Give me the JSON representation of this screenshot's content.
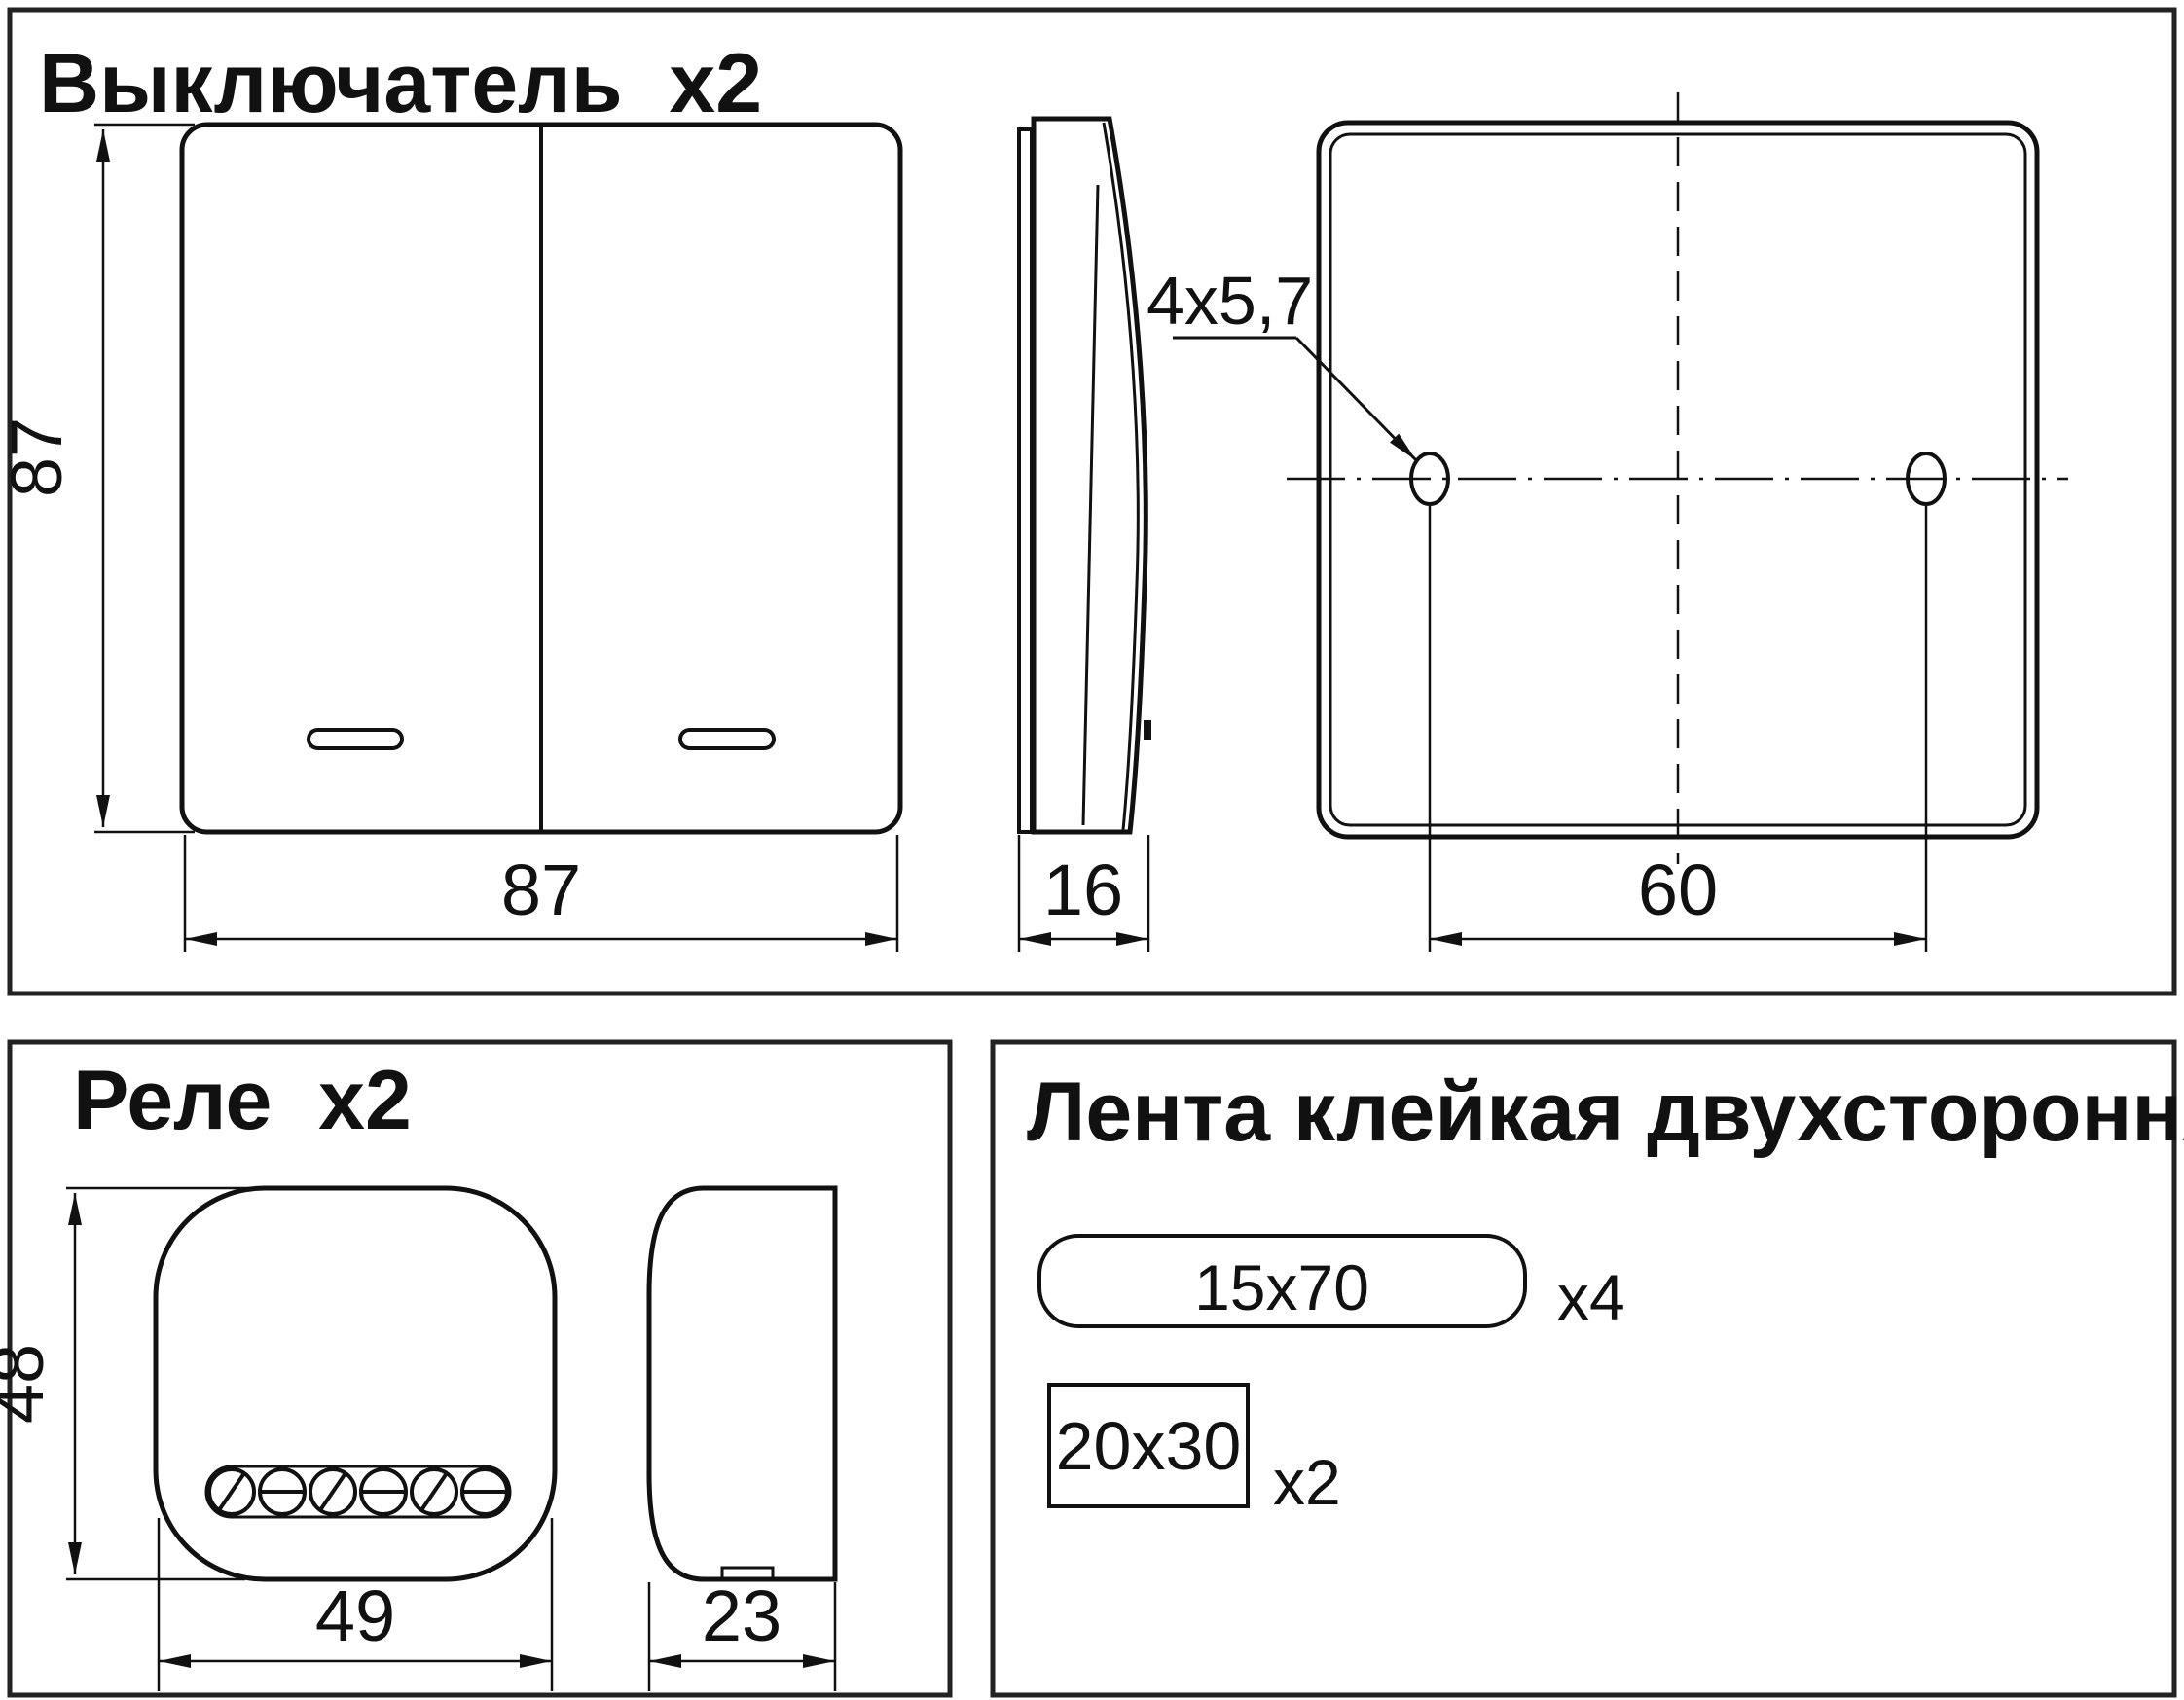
{
  "page": {
    "background": "#ffffff",
    "line_color": "#111111",
    "border_color": "#222222"
  },
  "panels": {
    "switch": {
      "title": "Выключатель  x2",
      "front_view": {
        "height_dim": "87",
        "width_dim": "87"
      },
      "side_view": {
        "depth_dim": "16"
      },
      "back_view": {
        "holes_note": "4x5,7",
        "hole_spacing_dim": "60"
      }
    },
    "relay": {
      "title": "Реле  x2",
      "front_view": {
        "height_dim": "48",
        "width_dim": "49"
      },
      "side_view": {
        "depth_dim": "23"
      }
    },
    "tape": {
      "title": "Лента клейкая двухсторонняя",
      "items": [
        {
          "size": "15x70",
          "qty": "x4"
        },
        {
          "size": "20x30",
          "qty": "x2"
        }
      ]
    }
  }
}
